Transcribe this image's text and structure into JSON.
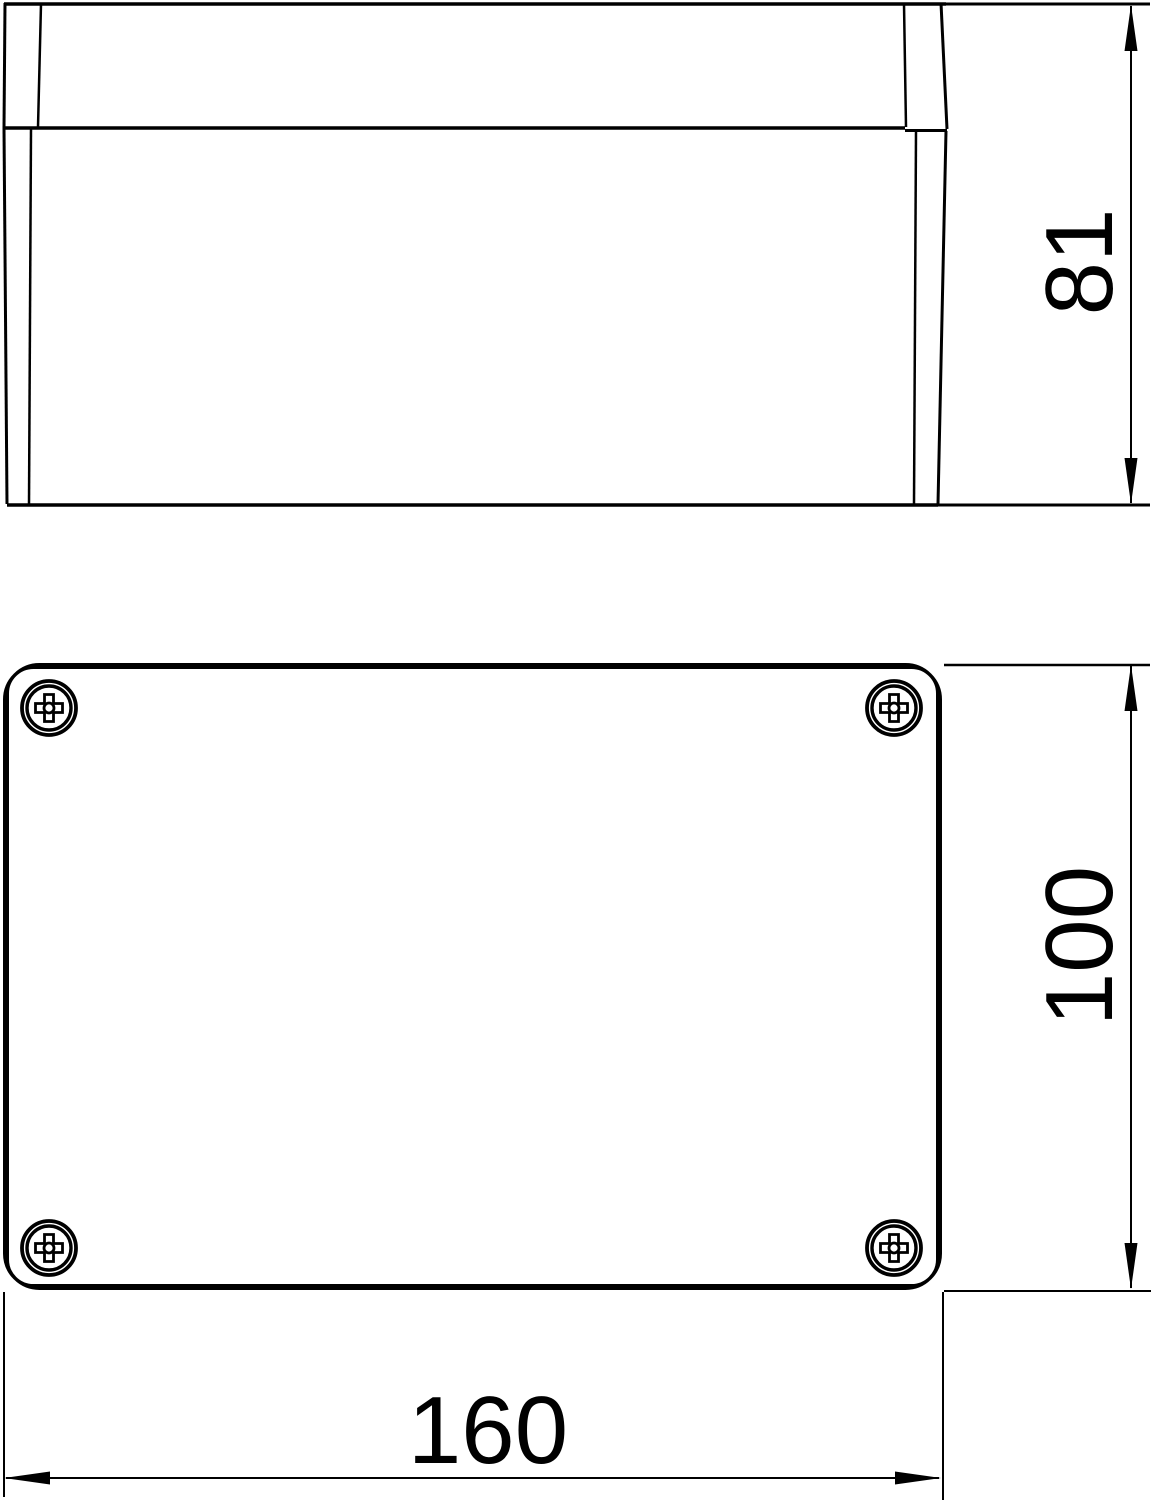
{
  "drawing": {
    "background_color": "#ffffff",
    "line_color": "#000000",
    "views": [
      {
        "id": "side-view",
        "description": "enclosure side elevation with lid"
      },
      {
        "id": "top-view",
        "description": "enclosure plan view with four lid screws"
      }
    ],
    "icons": {
      "screw": "phillips-screw-cross"
    },
    "dimensions": {
      "height": "81",
      "depth": "100",
      "width": "160"
    }
  }
}
